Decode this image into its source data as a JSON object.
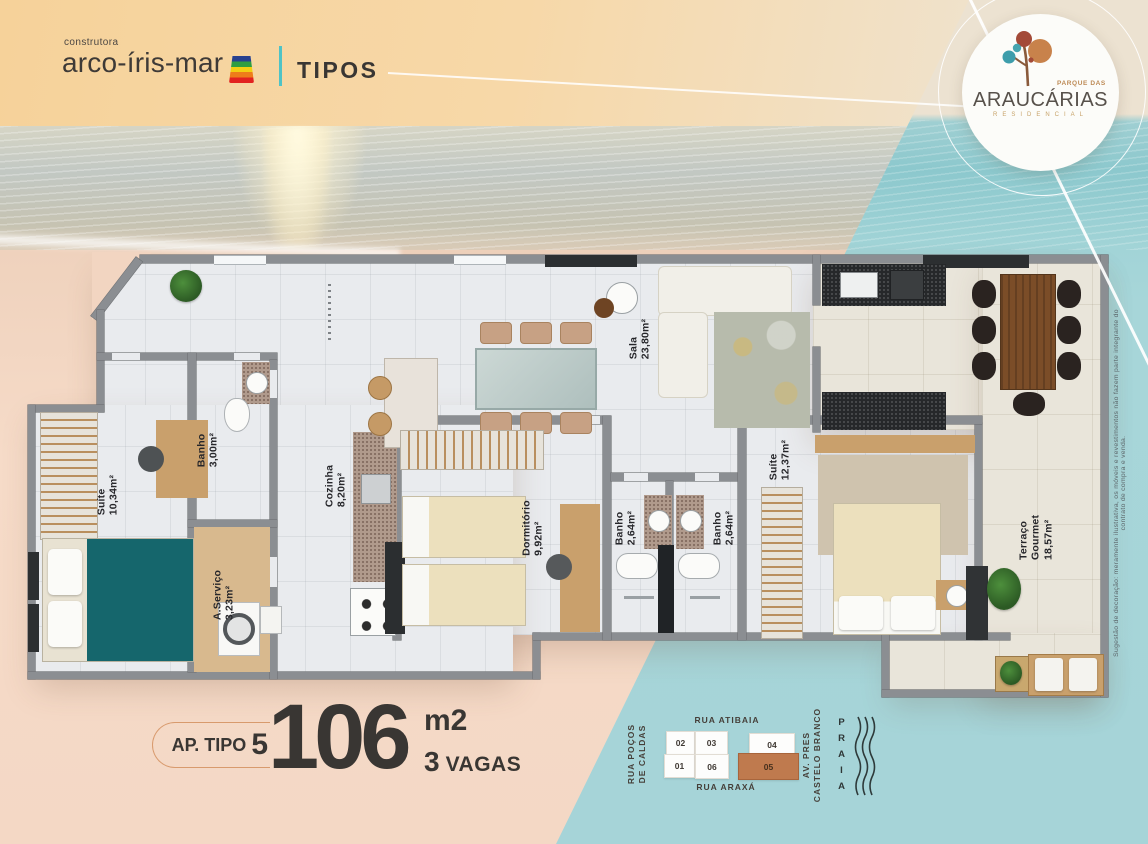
{
  "header": {
    "brand_small": "construtora",
    "brand_name": "arco-íris-mar",
    "section_title": "TIPOS"
  },
  "badge": {
    "top": "PARQUE DAS",
    "name": "ARAUCÁRIAS",
    "bottom": "RESIDENCIAL"
  },
  "unit_info": {
    "type_label": "AP. TIPO",
    "type_number": "5",
    "area_value": "106",
    "area_unit": "m2",
    "parking_value": "3",
    "parking_label": "VAGAS"
  },
  "floor_plan": {
    "rooms": [
      {
        "name": "Suíte",
        "area": "10,34m²"
      },
      {
        "name": "Banho",
        "area": "3,00m²"
      },
      {
        "name": "A.Serviço",
        "area": "3,23m²"
      },
      {
        "name": "Cozinha",
        "area": "8,20m²"
      },
      {
        "name": "Dormitório",
        "area": "9,92m²"
      },
      {
        "name": "Sala",
        "area": "23,80m²"
      },
      {
        "name": "Banho",
        "area": "2,64m²"
      },
      {
        "name": "Banho",
        "area": "2,64m²"
      },
      {
        "name": "Suíte",
        "area": "12,37m²"
      },
      {
        "name": "Terraço Gourmet",
        "area": "18,57m²"
      }
    ],
    "disclaimer": "Sugestão de decoração: meramente ilustrativa, os móveis e revestimentos não fazem parte integrante do contrato de compra e venda."
  },
  "site_map": {
    "street_top": "RUA ATIBAIA",
    "street_left": "RUA POÇOS\nDE CALDAS",
    "street_bottom": "RUA ARAXÁ",
    "street_right": "AV. PRES\nCASTELO BRANCO",
    "beach_label": "PRAIA",
    "units": [
      {
        "number": "02",
        "highlighted": false
      },
      {
        "number": "03",
        "highlighted": false
      },
      {
        "number": "04",
        "highlighted": false
      },
      {
        "number": "01",
        "highlighted": false
      },
      {
        "number": "06",
        "highlighted": false
      },
      {
        "number": "05",
        "highlighted": true
      }
    ]
  },
  "colors": {
    "accent_teal": "#4fc3c6",
    "unit_highlight": "#bf7a4e",
    "highlight_soft": "#d89a6d",
    "teal_panel": "#a6d4d8",
    "sand": "#f4d8c5",
    "wall_gray": "#8b8e92",
    "rainbow": [
      "#27418f",
      "#2f9e41",
      "#f2cf13",
      "#ee7d1a",
      "#e22320"
    ],
    "logo": {
      "rust": "#a34a38",
      "orange": "#c8824b",
      "teal": "#3d9dab"
    }
  }
}
